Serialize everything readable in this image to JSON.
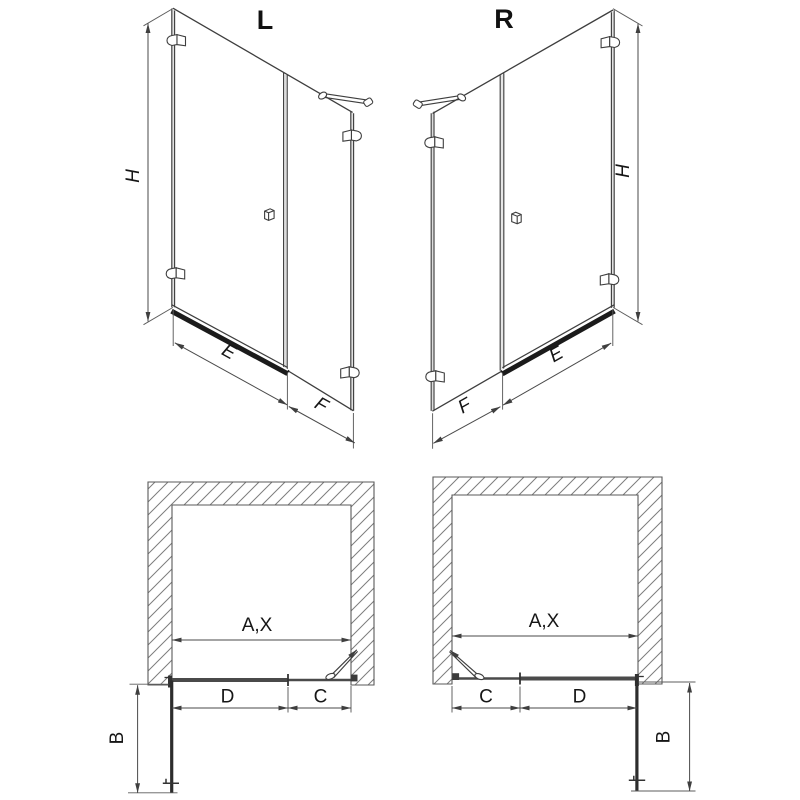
{
  "drawing": {
    "type": "shower-enclosure-dimension-diagram",
    "colors": {
      "line": "#3e3e3e",
      "dim_line": "#4a4a4a",
      "rail": "#1b1b1b",
      "hatch": "#7d7d7d",
      "text": "#161616",
      "background": "#ffffff"
    },
    "views": {
      "iso_left": {
        "title": "L",
        "height": "H",
        "panel_width": "E",
        "door_width": "F"
      },
      "iso_right": {
        "title": "R",
        "height": "H",
        "panel_width": "E",
        "door_width": "F"
      },
      "plan_left": {
        "opening": "A,X",
        "panel": "D",
        "door": "C",
        "side_panel": "B"
      },
      "plan_right": {
        "opening": "A,X",
        "panel": "D",
        "door": "C",
        "side_panel": "B"
      }
    }
  }
}
